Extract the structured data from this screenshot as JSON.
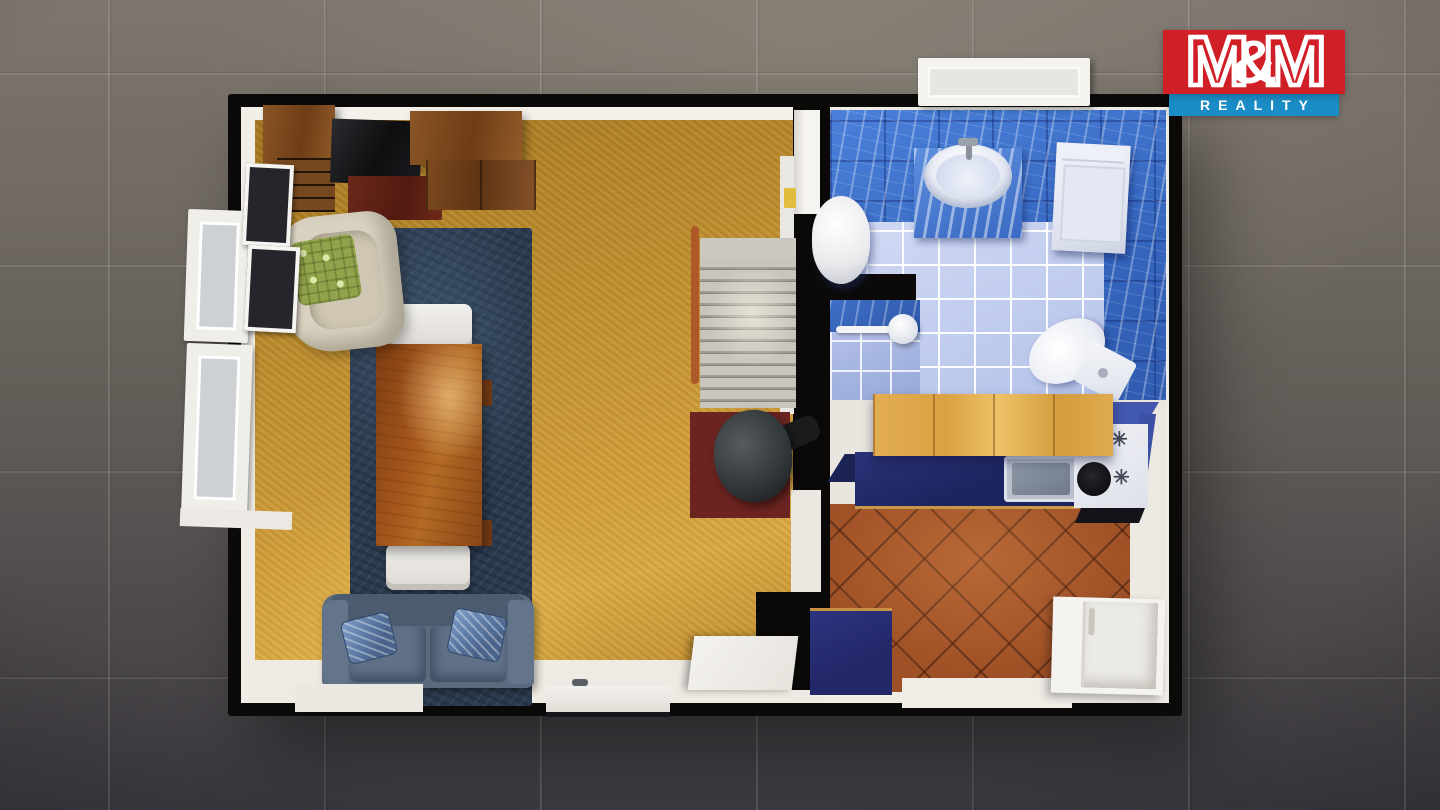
{
  "logo": {
    "m_left": "M",
    "ampersand": "&",
    "m_right": "M",
    "subtitle": "REALITY",
    "colors": {
      "red": "#d01f26",
      "blue": "#1b8dc6",
      "text": "#ffffff"
    }
  },
  "icons": {
    "burner": "✳"
  },
  "scene": {
    "description": "Top-down 3D rendered floor plan of a small apartment standing on a dark gray ceramic tile floor",
    "background_tile_color": "#69635e",
    "cut_wall_color": "#0c0a09",
    "rooms": [
      {
        "name": "living-room",
        "floor_color": "#c0902f",
        "rug_color": "#2c3c50",
        "furniture": [
          "wall-cabinet",
          "bookshelf",
          "tv",
          "tv-stand",
          "cabinet",
          "wardrobe",
          "armchair",
          "green-pillow",
          "area-rug",
          "dining-table",
          "chair",
          "chair",
          "sofa",
          "sofa-pillow",
          "sofa-pillow",
          "window",
          "window",
          "door"
        ]
      },
      {
        "name": "stair-hall",
        "furniture": [
          "staircase",
          "stair-handrail",
          "wood-stove",
          "hearth-pad",
          "open-door"
        ]
      },
      {
        "name": "bathroom",
        "wall_tile_color": "#3e73cb",
        "floor_tile_color": "#c4cfef",
        "fixtures": [
          "water-heater",
          "washbasin",
          "washing-machine",
          "toilet",
          "shower",
          "window",
          "door",
          "towel"
        ]
      },
      {
        "name": "kitchen",
        "floor_color": "#9e5026",
        "countertop_color": "#1c2460",
        "cabinet_color": "#dca54c",
        "fixtures": [
          "upper-cabinets",
          "countertop",
          "kitchen-sink",
          "cooktop",
          "oven",
          "refrigerator",
          "blue-cabinet"
        ]
      }
    ]
  }
}
